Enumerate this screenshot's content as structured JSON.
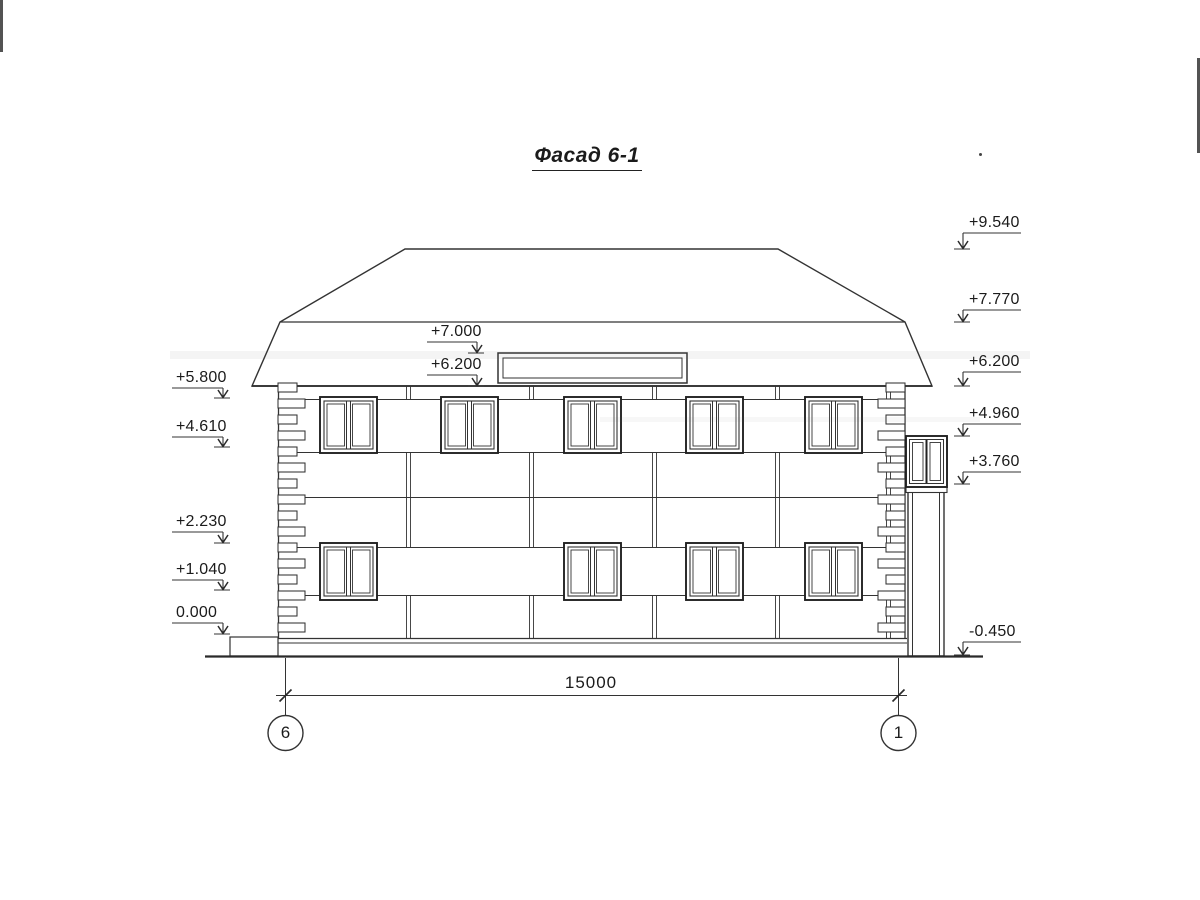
{
  "title": "Фасад 6-1",
  "marks": {
    "left": [
      {
        "label": "+5.800"
      },
      {
        "label": "+4.610"
      },
      {
        "label": "+2.230"
      },
      {
        "label": "+1.040"
      },
      {
        "label": "0.000"
      }
    ],
    "mid": [
      {
        "label": "+7.000"
      },
      {
        "label": "+6.200"
      }
    ],
    "right": [
      {
        "label": "+9.540"
      },
      {
        "label": "+7.770"
      },
      {
        "label": "+6.200"
      },
      {
        "label": "+4.960"
      },
      {
        "label": "+3.760"
      },
      {
        "label": "-0.450"
      }
    ]
  },
  "dimension": {
    "value": "15000"
  },
  "axes": {
    "left": "6",
    "right": "1"
  },
  "line_color": "#333333"
}
